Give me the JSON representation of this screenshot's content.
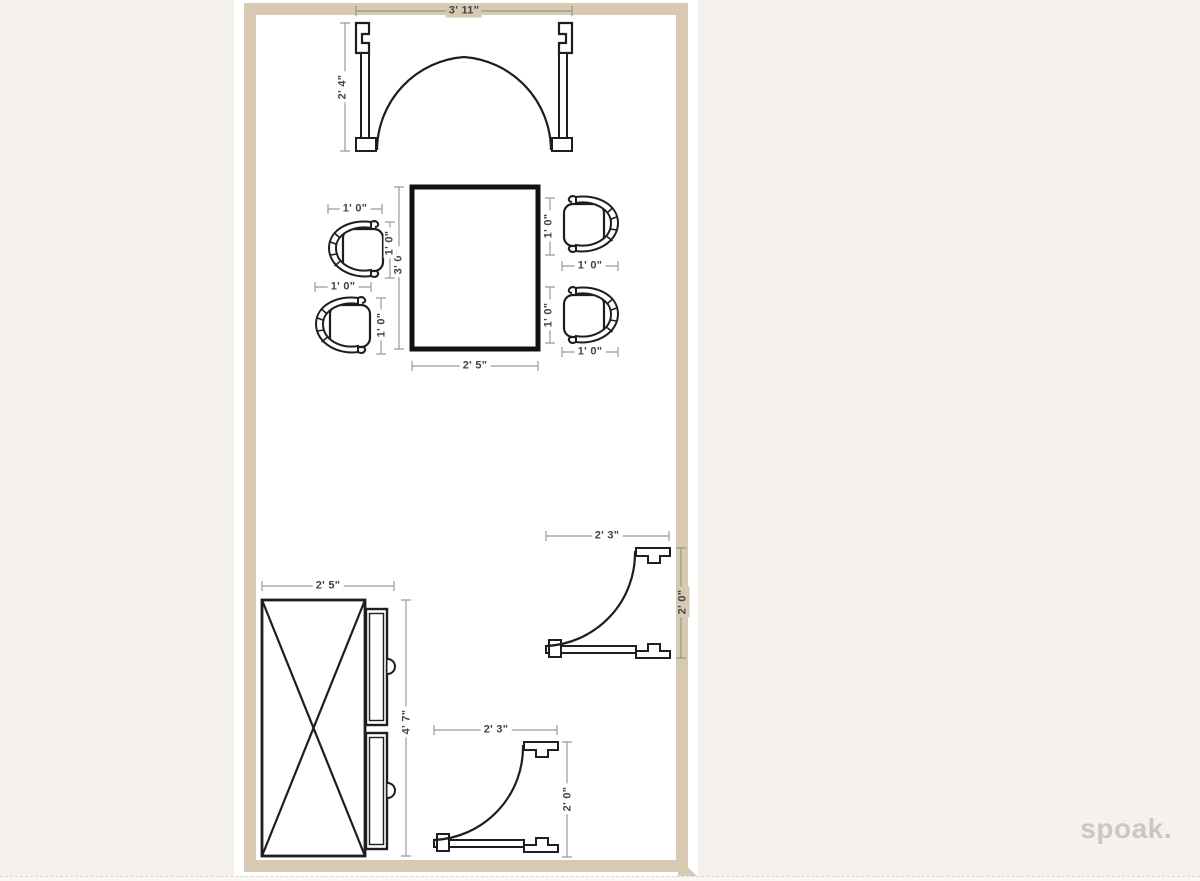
{
  "app": {
    "watermark": "spoak."
  },
  "dims": {
    "double_door_width": "3' 11\"",
    "double_door_depth": "2' 4\"",
    "table_width": "2' 5\"",
    "table_depth": "3' 0\"",
    "chair_size": "1' 0\"",
    "dresser_width": "2' 5\"",
    "dresser_height": "4' 7\"",
    "door_width": "2' 3\"",
    "door_depth": "2' 0\""
  },
  "furniture": {
    "double_door": "double-door-icon",
    "table": "rectangular-table-icon",
    "chairs": [
      "chair-icon",
      "chair-icon",
      "chair-icon",
      "chair-icon"
    ],
    "dresser": "dresser-with-drawers-icon",
    "single_doors": [
      "door-swing-icon",
      "door-swing-icon"
    ]
  },
  "colors": {
    "wall": "#d8c9b2",
    "floor": "#ffffff",
    "background": "#f5f2ed",
    "furniture_line": "#1e1e1c",
    "dim_line": "#8f8f8f",
    "dim_text": "#3f444c",
    "watermark": "#c9c8c3"
  }
}
